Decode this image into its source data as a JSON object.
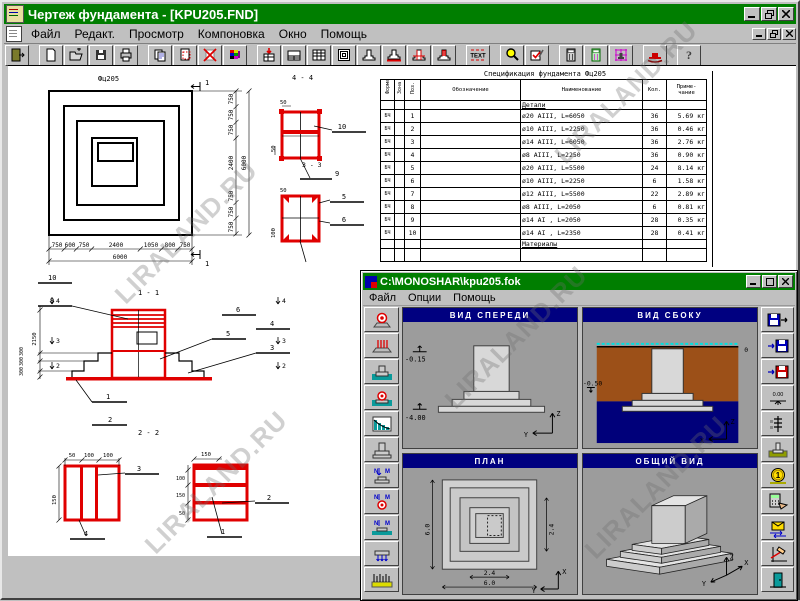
{
  "window": {
    "title": "Чертеж фундамента - [KPU205.FND]"
  },
  "menu": {
    "items": [
      "Файл",
      "Редакт.",
      "Просмотр",
      "Компоновка",
      "Окно",
      "Помощь"
    ]
  },
  "toolbar": {
    "text_label": "TEXT",
    "help_label": "?"
  },
  "watermark": {
    "text": "LIRALAND.RU"
  },
  "plan": {
    "label": "Фц205",
    "section_mark": "1",
    "bottom_dims": [
      "750",
      "600",
      "750",
      "2400",
      "1050",
      "800",
      "750"
    ],
    "bottom_total": "6000",
    "right_dims": [
      "750",
      "750",
      "750",
      "2400",
      "750",
      "750",
      "750"
    ],
    "right_total": "6000"
  },
  "details_top": {
    "title_4_4": "4 - 4",
    "title_3_3": "3 - 3",
    "dim_50a": "50",
    "dim_50b": "50",
    "dim_50c": "50",
    "dim_100": "100",
    "callout_10": "10",
    "callout_9": "9",
    "callout_5": "5",
    "callout_6": "6"
  },
  "elevation": {
    "title_1_1": "1 - 1",
    "title_2_2": "2 - 2",
    "dim_2150": "2150",
    "step_dims": [
      "300",
      "300",
      "300"
    ],
    "callouts": {
      "c10": "10",
      "c9": "9",
      "c6": "6",
      "c5": "5",
      "c4": "4",
      "c3": "3",
      "c1": "1",
      "c2": "2"
    },
    "marks": {
      "m4": "4",
      "m3": "3",
      "m2": "2"
    }
  },
  "details_bottom": {
    "left": {
      "top_dims": [
        "50",
        "100",
        "100"
      ],
      "side_dim": "150",
      "callout_top": "3",
      "callout_bottom": "4"
    },
    "right": {
      "top_dim": "150",
      "side_dims": [
        "100",
        "150",
        "50"
      ],
      "callout_mid": "2",
      "callout_bottom": "1"
    }
  },
  "spec": {
    "title": "Спецификация фундамента Фц205",
    "col_format": "Формат",
    "col_zone": "Зона",
    "col_pos": "Поз.",
    "col_designation": "Обозначение",
    "col_name": "Наименование",
    "col_qty": "Кол.",
    "col_note1": "Приме-",
    "col_note2": "чание",
    "section_details": "Детали",
    "section_materials": "Материалы",
    "rows": [
      {
        "fmt": "БЧ",
        "pos": "1",
        "name": "ø20 AIII, L=6050",
        "qty": "36",
        "note": "5.69 кг"
      },
      {
        "fmt": "БЧ",
        "pos": "2",
        "name": "ø10 AIII, L=2250",
        "qty": "36",
        "note": "0.46 кг"
      },
      {
        "fmt": "БЧ",
        "pos": "3",
        "name": "ø14 AIII, L=6050",
        "qty": "36",
        "note": "2.76 кг"
      },
      {
        "fmt": "БЧ",
        "pos": "4",
        "name": "ø8 AIII, L=2250",
        "qty": "36",
        "note": "0.90 кг"
      },
      {
        "fmt": "БЧ",
        "pos": "5",
        "name": "ø20 AIII, L=5500",
        "qty": "24",
        "note": "8.14 кг"
      },
      {
        "fmt": "БЧ",
        "pos": "6",
        "name": "ø10 AIII, L=2250",
        "qty": "6",
        "note": "1.58 кг"
      },
      {
        "fmt": "БЧ",
        "pos": "7",
        "name": "ø12 AIII, L=5500",
        "qty": "22",
        "note": "2.89 кг"
      },
      {
        "fmt": "БЧ",
        "pos": "8",
        "name": "ø8 AIII, L=2050",
        "qty": "6",
        "note": "0.81 кг"
      },
      {
        "fmt": "БЧ",
        "pos": "9",
        "name": "ø14 AI , L=2050",
        "qty": "28",
        "note": "0.35 кг"
      },
      {
        "fmt": "БЧ",
        "pos": "10",
        "name": "ø14 AI , L=2350",
        "qty": "28",
        "note": "0.41 кг"
      }
    ]
  },
  "child": {
    "title": "C:\\MONOSHAR\\kpu205.fok",
    "menu": [
      "Файл",
      "Опции",
      "Помощь"
    ],
    "front": {
      "title": "ВИД СПЕРЕДИ",
      "level_top": "-0.15",
      "level_bottom": "-4.00",
      "axis_v": "Z",
      "axis_h": "Y"
    },
    "side": {
      "title": "ВИД СБОКУ",
      "level": "-0.50",
      "zero": "0",
      "axis_v": "Z",
      "axis_h": "X"
    },
    "plan": {
      "title": "ПЛАН",
      "dim_left": "6.0",
      "dim_right": "2.4",
      "dim_b1": "2.4",
      "dim_b2": "6.0",
      "axis_v": "X",
      "axis_h": "Y"
    },
    "general": {
      "title": "ОБЩИЙ ВИД",
      "axis_v": "Z",
      "axis_h": "Y",
      "axis_d": "X"
    },
    "icons": {
      "level_label": "0.00",
      "coin_label": "1",
      "n": "N",
      "m": "M"
    }
  }
}
